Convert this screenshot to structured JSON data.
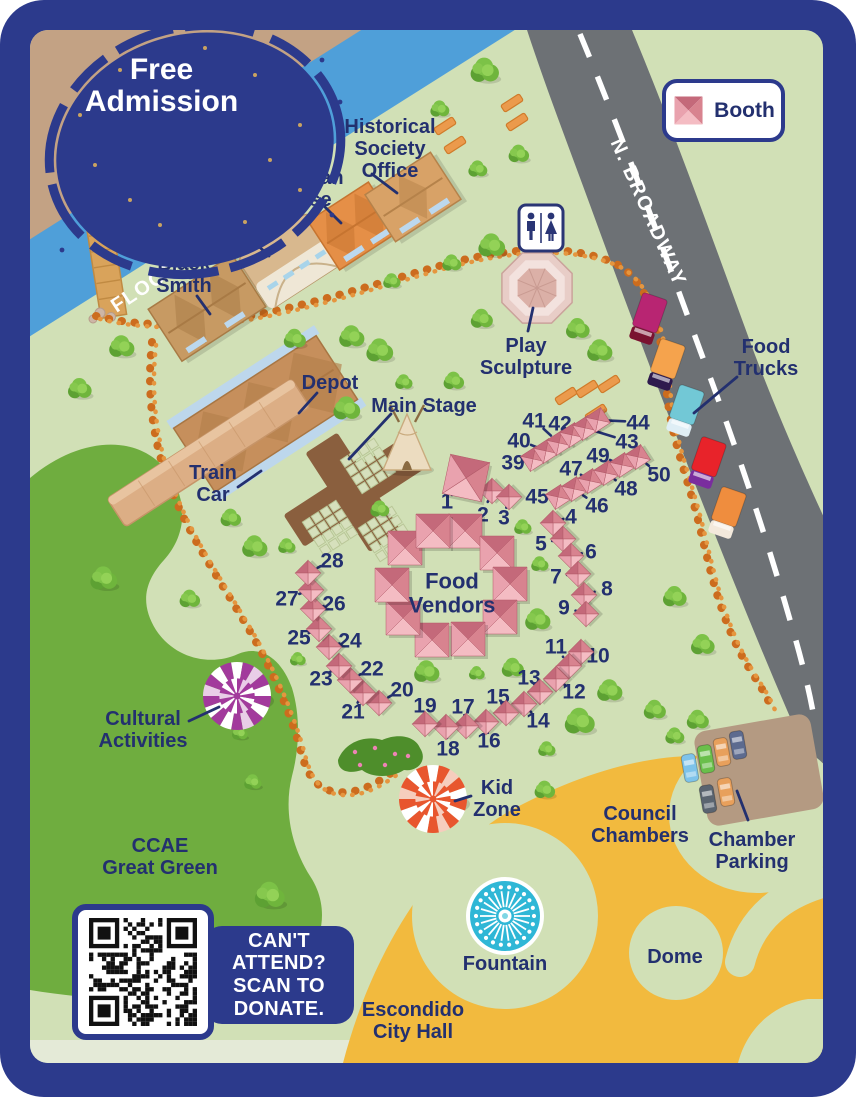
{
  "admission": {
    "lines": [
      "Free",
      "Admission"
    ]
  },
  "legend": {
    "booth_label": "Booth"
  },
  "donate_panel": {
    "lines": [
      "CAN'T",
      "ATTEND?",
      "SCAN TO",
      "DONATE."
    ]
  },
  "palette": {
    "frame": "#2c3a8c",
    "map_bg": "#d1e0b6",
    "ccae_green": "#6fad3f",
    "water": "#4f9fd9",
    "road": "#6d7175",
    "sand": "#c3a284",
    "civic_yellow": "#f2ba3e",
    "trail": "#cc6c1e",
    "label": "#23306f",
    "booth_dark": "#c4697a",
    "booth_light": "#f4bcc3"
  },
  "map_labels": [
    {
      "id": "flood-channel",
      "lines": [
        "FLOOD CHANNEL"
      ],
      "x": 193,
      "y": 254,
      "size": 20,
      "rot": -33.5,
      "white": true,
      "spacing": 1.5
    },
    {
      "id": "n-broadway",
      "lines": [
        "N. BROADWAY"
      ],
      "x": 649,
      "y": 212,
      "size": 20,
      "rot": 66,
      "white": true,
      "spacing": 1.5
    },
    {
      "id": "black-smith",
      "lines": [
        "Black",
        "Smith"
      ],
      "x": 184,
      "y": 263,
      "size": 20,
      "leader": [
        197,
        296,
        210,
        314
      ]
    },
    {
      "id": "barn",
      "lines": [
        "Barn"
      ],
      "x": 249,
      "y": 223,
      "size": 20,
      "leader": [
        249,
        237,
        269,
        256
      ]
    },
    {
      "id": "victorian-house",
      "lines": [
        "Victorian",
        "House"
      ],
      "x": 301,
      "y": 177,
      "size": 20,
      "leader": [
        322,
        204,
        341,
        223
      ]
    },
    {
      "id": "historical-society-office",
      "lines": [
        "Historical",
        "Society",
        "Office"
      ],
      "x": 390,
      "y": 126,
      "size": 20,
      "leader": [
        372,
        174,
        397,
        193
      ]
    },
    {
      "id": "depot",
      "lines": [
        "Depot"
      ],
      "x": 330,
      "y": 382,
      "size": 20,
      "leader": [
        317,
        393,
        299,
        413
      ]
    },
    {
      "id": "main-stage",
      "lines": [
        "Main Stage"
      ],
      "x": 424,
      "y": 405,
      "size": 20,
      "leader": [
        391,
        414,
        349,
        459
      ]
    },
    {
      "id": "train-car",
      "lines": [
        "Train",
        "Car"
      ],
      "x": 213,
      "y": 472,
      "size": 20,
      "leader": [
        238,
        487,
        261,
        471
      ]
    },
    {
      "id": "play-sculpture",
      "lines": [
        "Play",
        "Sculpture"
      ],
      "x": 526,
      "y": 345,
      "size": 20,
      "leader": [
        533,
        308,
        528,
        331
      ]
    },
    {
      "id": "food-trucks",
      "lines": [
        "Food",
        "Trucks"
      ],
      "x": 766,
      "y": 346,
      "size": 20,
      "leader": [
        737,
        377,
        694,
        413
      ]
    },
    {
      "id": "food-vendors",
      "lines": [
        "Food",
        "Vendors"
      ],
      "x": 452,
      "y": 581,
      "size": 22
    },
    {
      "id": "cultural-activities",
      "lines": [
        "Cultural",
        "Activities"
      ],
      "x": 143,
      "y": 718,
      "size": 20,
      "leader": [
        189,
        721,
        219,
        707
      ]
    },
    {
      "id": "kid-zone",
      "lines": [
        "Kid",
        "Zone"
      ],
      "x": 497,
      "y": 787,
      "size": 20,
      "leader": [
        471,
        796,
        455,
        801
      ]
    },
    {
      "id": "ccae-great-green",
      "lines": [
        "CCAE",
        "Great Green"
      ],
      "x": 160,
      "y": 845,
      "size": 20
    },
    {
      "id": "council-chambers",
      "lines": [
        "Council",
        "Chambers"
      ],
      "x": 640,
      "y": 813,
      "size": 20
    },
    {
      "id": "chamber-parking",
      "lines": [
        "Chamber",
        "Parking"
      ],
      "x": 752,
      "y": 839,
      "size": 20,
      "leader": [
        737,
        791,
        748,
        820
      ]
    },
    {
      "id": "fountain",
      "lines": [
        "Fountain"
      ],
      "x": 505,
      "y": 963,
      "size": 20
    },
    {
      "id": "dome",
      "lines": [
        "Dome"
      ],
      "x": 675,
      "y": 956,
      "size": 20
    },
    {
      "id": "escondido-city-hall",
      "lines": [
        "Escondido",
        "City Hall"
      ],
      "x": 413,
      "y": 1009,
      "size": 20
    }
  ],
  "booths": {
    "featured": {
      "n": "1",
      "x": 466,
      "y": 478,
      "lx": 447,
      "ly": 501
    },
    "vendor_ring": [
      {
        "n": "29",
        "x": 465,
        "y": 531
      },
      {
        "n": "30",
        "x": 497,
        "y": 553
      },
      {
        "n": "31",
        "x": 510,
        "y": 584
      },
      {
        "n": "32",
        "x": 500,
        "y": 617
      },
      {
        "n": "33",
        "x": 468,
        "y": 639
      },
      {
        "n": "34",
        "x": 432,
        "y": 640
      },
      {
        "n": "35",
        "x": 403,
        "y": 618
      },
      {
        "n": "36",
        "x": 392,
        "y": 585
      },
      {
        "n": "37",
        "x": 405,
        "y": 548
      },
      {
        "n": "38",
        "x": 433,
        "y": 531
      }
    ],
    "small": [
      {
        "n": "2",
        "x": 492,
        "y": 491,
        "lx": 483,
        "ly": 514
      },
      {
        "n": "3",
        "x": 509,
        "y": 497,
        "lx": 504,
        "ly": 517
      },
      {
        "n": "4",
        "x": 553,
        "y": 523,
        "lx": 571,
        "ly": 516
      },
      {
        "n": "5",
        "x": 563,
        "y": 539,
        "lx": 541,
        "ly": 543
      },
      {
        "n": "6",
        "x": 571,
        "y": 556,
        "lx": 591,
        "ly": 551
      },
      {
        "n": "7",
        "x": 578,
        "y": 574,
        "lx": 556,
        "ly": 576
      },
      {
        "n": "8",
        "x": 584,
        "y": 595,
        "lx": 607,
        "ly": 588
      },
      {
        "n": "9",
        "x": 586,
        "y": 614,
        "lx": 564,
        "ly": 607
      },
      {
        "n": "10",
        "x": 581,
        "y": 652,
        "lx": 598,
        "ly": 655
      },
      {
        "n": "11",
        "x": 569,
        "y": 666,
        "lx": 556,
        "ly": 646
      },
      {
        "n": "12",
        "x": 556,
        "y": 679,
        "lx": 574,
        "ly": 691
      },
      {
        "n": "13",
        "x": 540,
        "y": 692,
        "lx": 529,
        "ly": 677
      },
      {
        "n": "14",
        "x": 524,
        "y": 704,
        "lx": 538,
        "ly": 720
      },
      {
        "n": "15",
        "x": 506,
        "y": 713,
        "lx": 498,
        "ly": 696
      },
      {
        "n": "16",
        "x": 486,
        "y": 722,
        "lx": 489,
        "ly": 740
      },
      {
        "n": "17",
        "x": 466,
        "y": 726,
        "lx": 463,
        "ly": 706
      },
      {
        "n": "18",
        "x": 446,
        "y": 727,
        "lx": 448,
        "ly": 748
      },
      {
        "n": "19",
        "x": 425,
        "y": 724,
        "lx": 425,
        "ly": 705
      },
      {
        "n": "20",
        "x": 379,
        "y": 703,
        "lx": 402,
        "ly": 689
      },
      {
        "n": "21",
        "x": 363,
        "y": 693,
        "lx": 353,
        "ly": 711
      },
      {
        "n": "22",
        "x": 350,
        "y": 680,
        "lx": 372,
        "ly": 668
      },
      {
        "n": "23",
        "x": 339,
        "y": 666,
        "lx": 321,
        "ly": 678
      },
      {
        "n": "24",
        "x": 329,
        "y": 647,
        "lx": 350,
        "ly": 640
      },
      {
        "n": "25",
        "x": 319,
        "y": 629,
        "lx": 299,
        "ly": 637
      },
      {
        "n": "26",
        "x": 313,
        "y": 609,
        "lx": 334,
        "ly": 603
      },
      {
        "n": "27",
        "x": 311,
        "y": 590,
        "lx": 287,
        "ly": 598
      },
      {
        "n": "28",
        "x": 308,
        "y": 573,
        "lx": 332,
        "ly": 560
      },
      {
        "n": "39",
        "x": 533,
        "y": 459,
        "lx": 513,
        "ly": 462
      },
      {
        "n": "40",
        "x": 546,
        "y": 451,
        "lx": 519,
        "ly": 440
      },
      {
        "n": "41",
        "x": 559,
        "y": 443,
        "lx": 534,
        "ly": 420
      },
      {
        "n": "42",
        "x": 572,
        "y": 435,
        "lx": 560,
        "ly": 423
      },
      {
        "n": "43",
        "x": 585,
        "y": 428,
        "lx": 627,
        "ly": 441
      },
      {
        "n": "44",
        "x": 598,
        "y": 420,
        "lx": 638,
        "ly": 422
      },
      {
        "n": "45",
        "x": 558,
        "y": 497,
        "lx": 537,
        "ly": 496
      },
      {
        "n": "46",
        "x": 574,
        "y": 489,
        "lx": 597,
        "ly": 505
      },
      {
        "n": "47",
        "x": 590,
        "y": 481,
        "lx": 571,
        "ly": 468
      },
      {
        "n": "48",
        "x": 606,
        "y": 473,
        "lx": 626,
        "ly": 488
      },
      {
        "n": "49",
        "x": 622,
        "y": 465,
        "lx": 598,
        "ly": 455
      },
      {
        "n": "50",
        "x": 638,
        "y": 457,
        "lx": 659,
        "ly": 474
      }
    ]
  },
  "food_trucks": [
    {
      "body": "#b82572",
      "cab": "#7a1230"
    },
    {
      "body": "#f5a34d",
      "cab": "#2e1a4e"
    },
    {
      "body": "#72c8d6",
      "cab": "#dfeef5"
    },
    {
      "body": "#e8232a",
      "cab": "#7a2d9e"
    },
    {
      "body": "#ef8d3e",
      "cab": "#f3e9dc"
    }
  ],
  "cars": [
    "#7ec3ea",
    "#6abf4b",
    "#e8a05c",
    "#5d6b8f",
    "#5a6470",
    "#e8a05c"
  ]
}
